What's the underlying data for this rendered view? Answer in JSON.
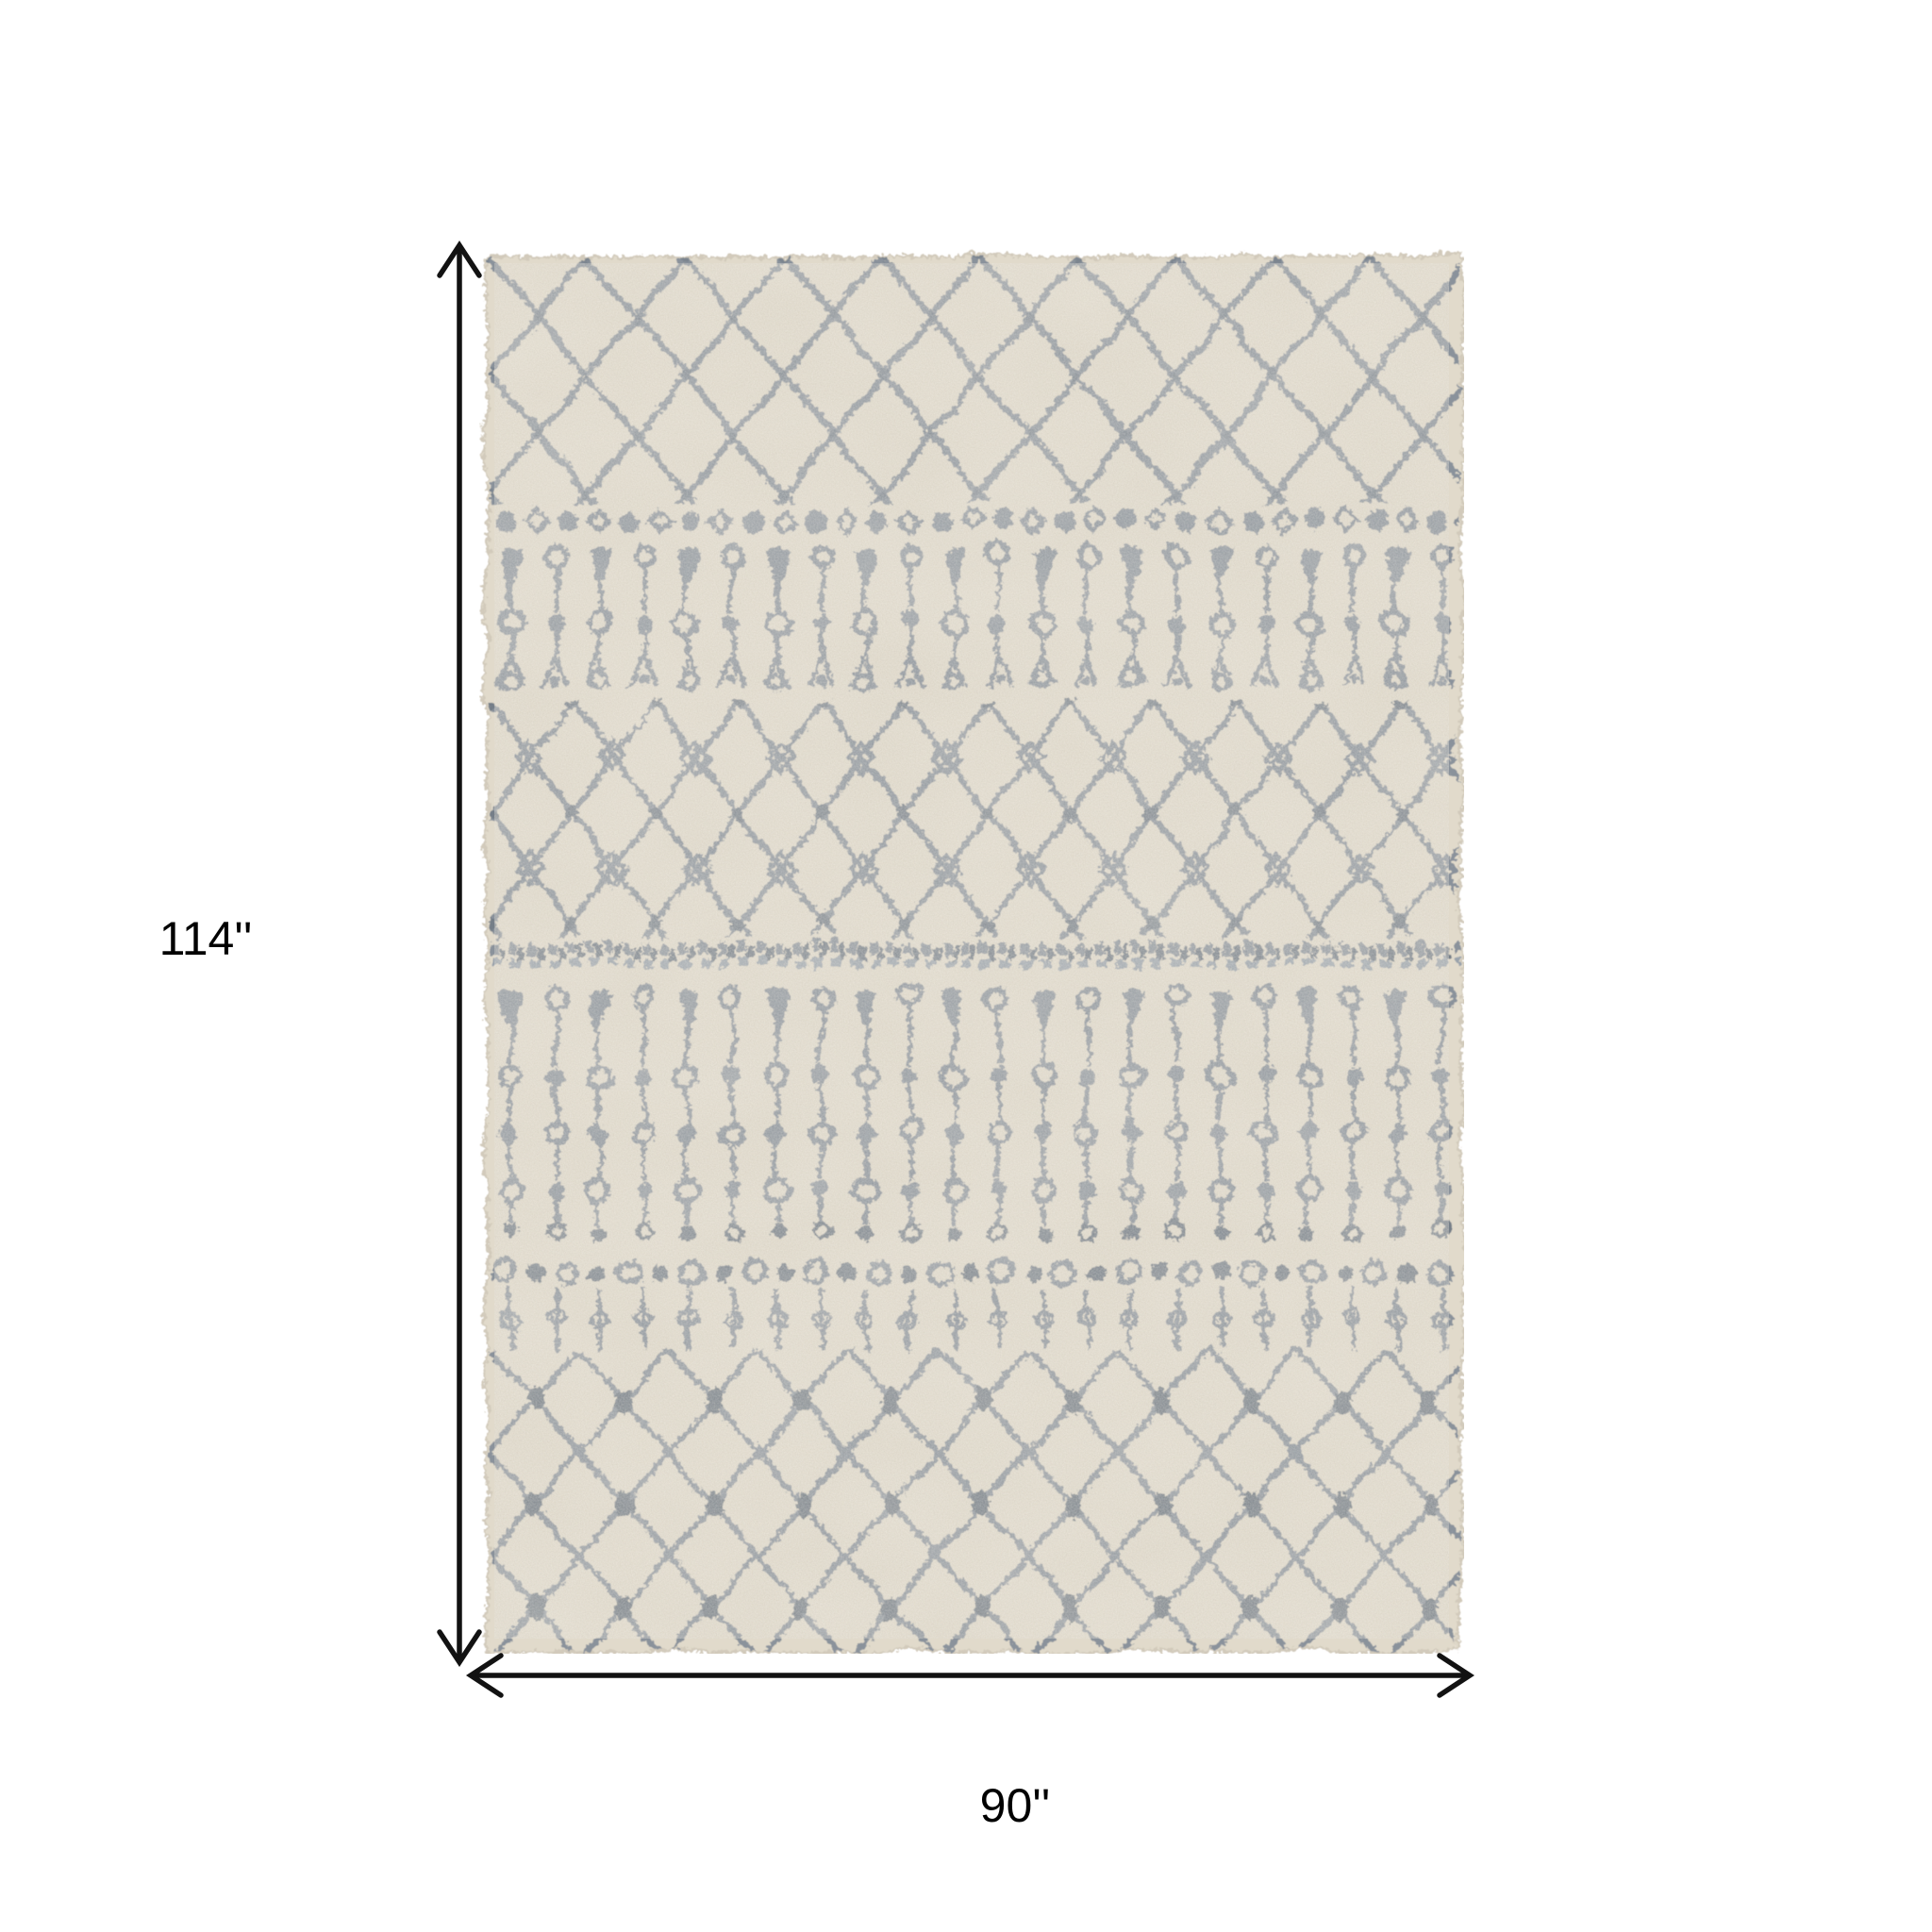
{
  "page": {
    "background_color": "#ffffff"
  },
  "diagram": {
    "type": "product-dimension-diagram",
    "product": "ivory and gray moroccan trellis shag area rug",
    "height_label": "114''",
    "width_label": "90''",
    "arrow_color": "#121212",
    "label_color": "#000000",
    "rug_colors": {
      "base": "#e1dacb",
      "pattern": "#8a929b",
      "pattern_dark": "#707a84",
      "edge": "#d2cabb"
    }
  }
}
